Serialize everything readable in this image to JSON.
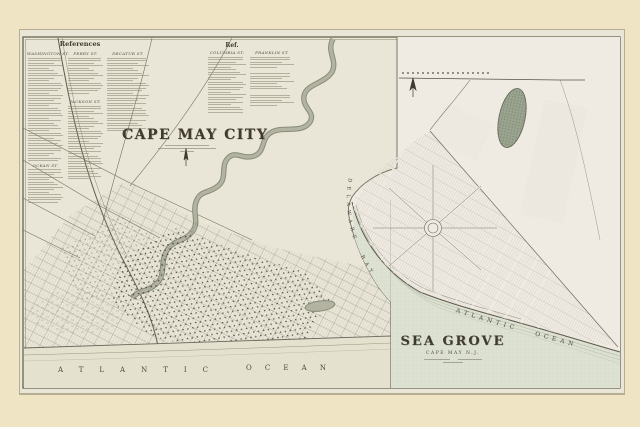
{
  "page": {
    "background": "#efe4c3",
    "sheet_paper": "#e9e6d7",
    "inset_paper": "#efeae2",
    "water": "#dde1d2",
    "ink": "#444033"
  },
  "references": {
    "title": "References",
    "columns": [
      {
        "header": "WASHINGTON ST.",
        "subheader": "OCEAN ST."
      },
      {
        "header": "PERRY ST.",
        "subheader": "JACKSON ST."
      },
      {
        "header": "DECATUR ST."
      }
    ]
  },
  "ref2": {
    "title": "Ref.",
    "columns": [
      {
        "header": "COLUMBIA ST."
      },
      {
        "header": "FRANKLIN ST."
      }
    ]
  },
  "main_map": {
    "title": "CAPE MAY CITY",
    "ocean_word1": "ATLANTIC",
    "ocean_word2": "OCEAN"
  },
  "inset_map": {
    "title": "SEA GROVE",
    "subtitle": "CAPE MAY N.J.",
    "ocean_label": "ATLANTIC OCEAN",
    "bay_label": "DELAWARE BAY"
  }
}
